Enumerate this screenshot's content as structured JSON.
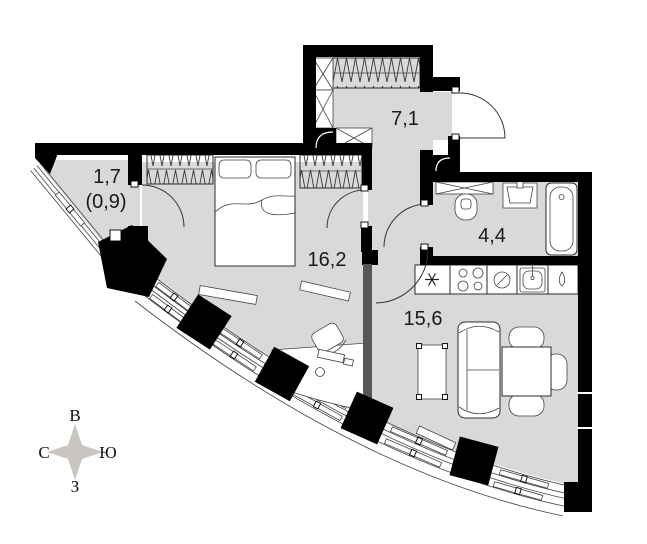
{
  "plan": {
    "title": "apartment-floor-plan",
    "rooms": [
      {
        "id": "hallway",
        "area": "7,1"
      },
      {
        "id": "balcony",
        "area": "1,7",
        "area_reduced": "(0,9)"
      },
      {
        "id": "bedroom",
        "area": "16,2"
      },
      {
        "id": "bathroom",
        "area": "4,4"
      },
      {
        "id": "kitchen_living",
        "area": "15,6"
      }
    ],
    "compass": {
      "top": "В",
      "left": "С",
      "right": "Ю",
      "bottom": "З"
    },
    "colors": {
      "floor": "#d9d9d9",
      "wall": "#000000",
      "partition": "#575757",
      "compass_star": "#c9c5c0"
    },
    "fixtures": [
      "bed-icon",
      "wardrobe-icon",
      "closet-icon",
      "toilet-icon",
      "washbasin-icon",
      "bathtub-icon",
      "fridge-icon",
      "stove-icon",
      "round-sink-icon",
      "kitchen-sink-icon",
      "water-drop-icon",
      "sofa-icon",
      "dining-table-icon",
      "chair-icon",
      "coffee-table-icon",
      "desk-icon",
      "door-arc-icon",
      "shaft-x-icon",
      "column-icon",
      "window-band-icon",
      "compass-rose-icon"
    ]
  }
}
